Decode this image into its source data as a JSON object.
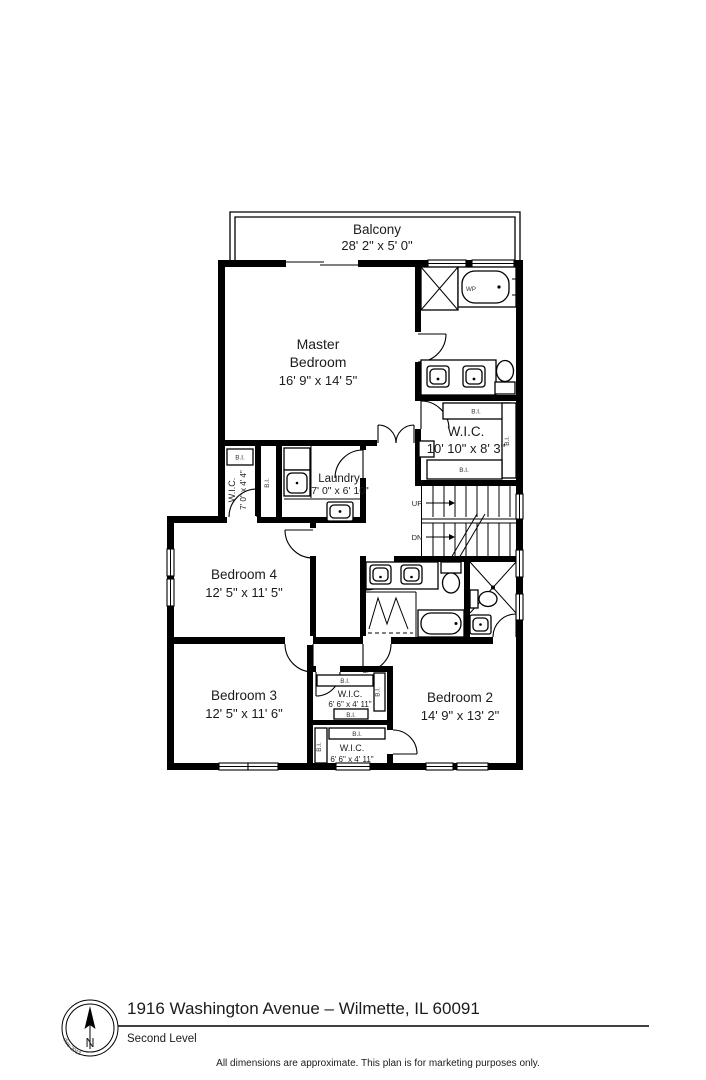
{
  "footer": {
    "address": "1916 Washington Avenue – Wilmette, IL 60091",
    "level_name": "Second Level",
    "disclaimer": "All dimensions are approximate. This plan is for marketing purposes only.",
    "compass_north": "N",
    "compass_credit": "© VHT Studios 2013"
  },
  "rooms": {
    "balcony": {
      "name": "Balcony",
      "dims": "28' 2\" x 5' 0\""
    },
    "master_bedroom": {
      "name1": "Master",
      "name2": "Bedroom",
      "dims": "16' 9\" x 14' 5\""
    },
    "master_wic": {
      "name": "W.I.C.",
      "dims": "10' 10\" x 8' 3\""
    },
    "hall_wic": {
      "name": "W.I.C.",
      "dims": "7' 0\" x 4' 4\""
    },
    "laundry": {
      "name": "Laundry",
      "dims": "7' 0\" x 6' 10\""
    },
    "bedroom4": {
      "name": "Bedroom 4",
      "dims": "12' 5\" x 11' 5\""
    },
    "bedroom3": {
      "name": "Bedroom 3",
      "dims": "12' 5\" x 11' 6\""
    },
    "bedroom2": {
      "name": "Bedroom 2",
      "dims": "14' 9\" x 13' 2\""
    },
    "bedroom3_wic": {
      "name": "W.I.C.",
      "dims": "6' 6\" x 4' 11\""
    },
    "bedroom2_wic": {
      "name": "W.I.C.",
      "dims": "6' 6\" x 4' 11\""
    }
  },
  "annotations": {
    "built_in": "B.I.",
    "stairs_up": "UP",
    "stairs_down": "DN",
    "whirlpool": "WP"
  }
}
